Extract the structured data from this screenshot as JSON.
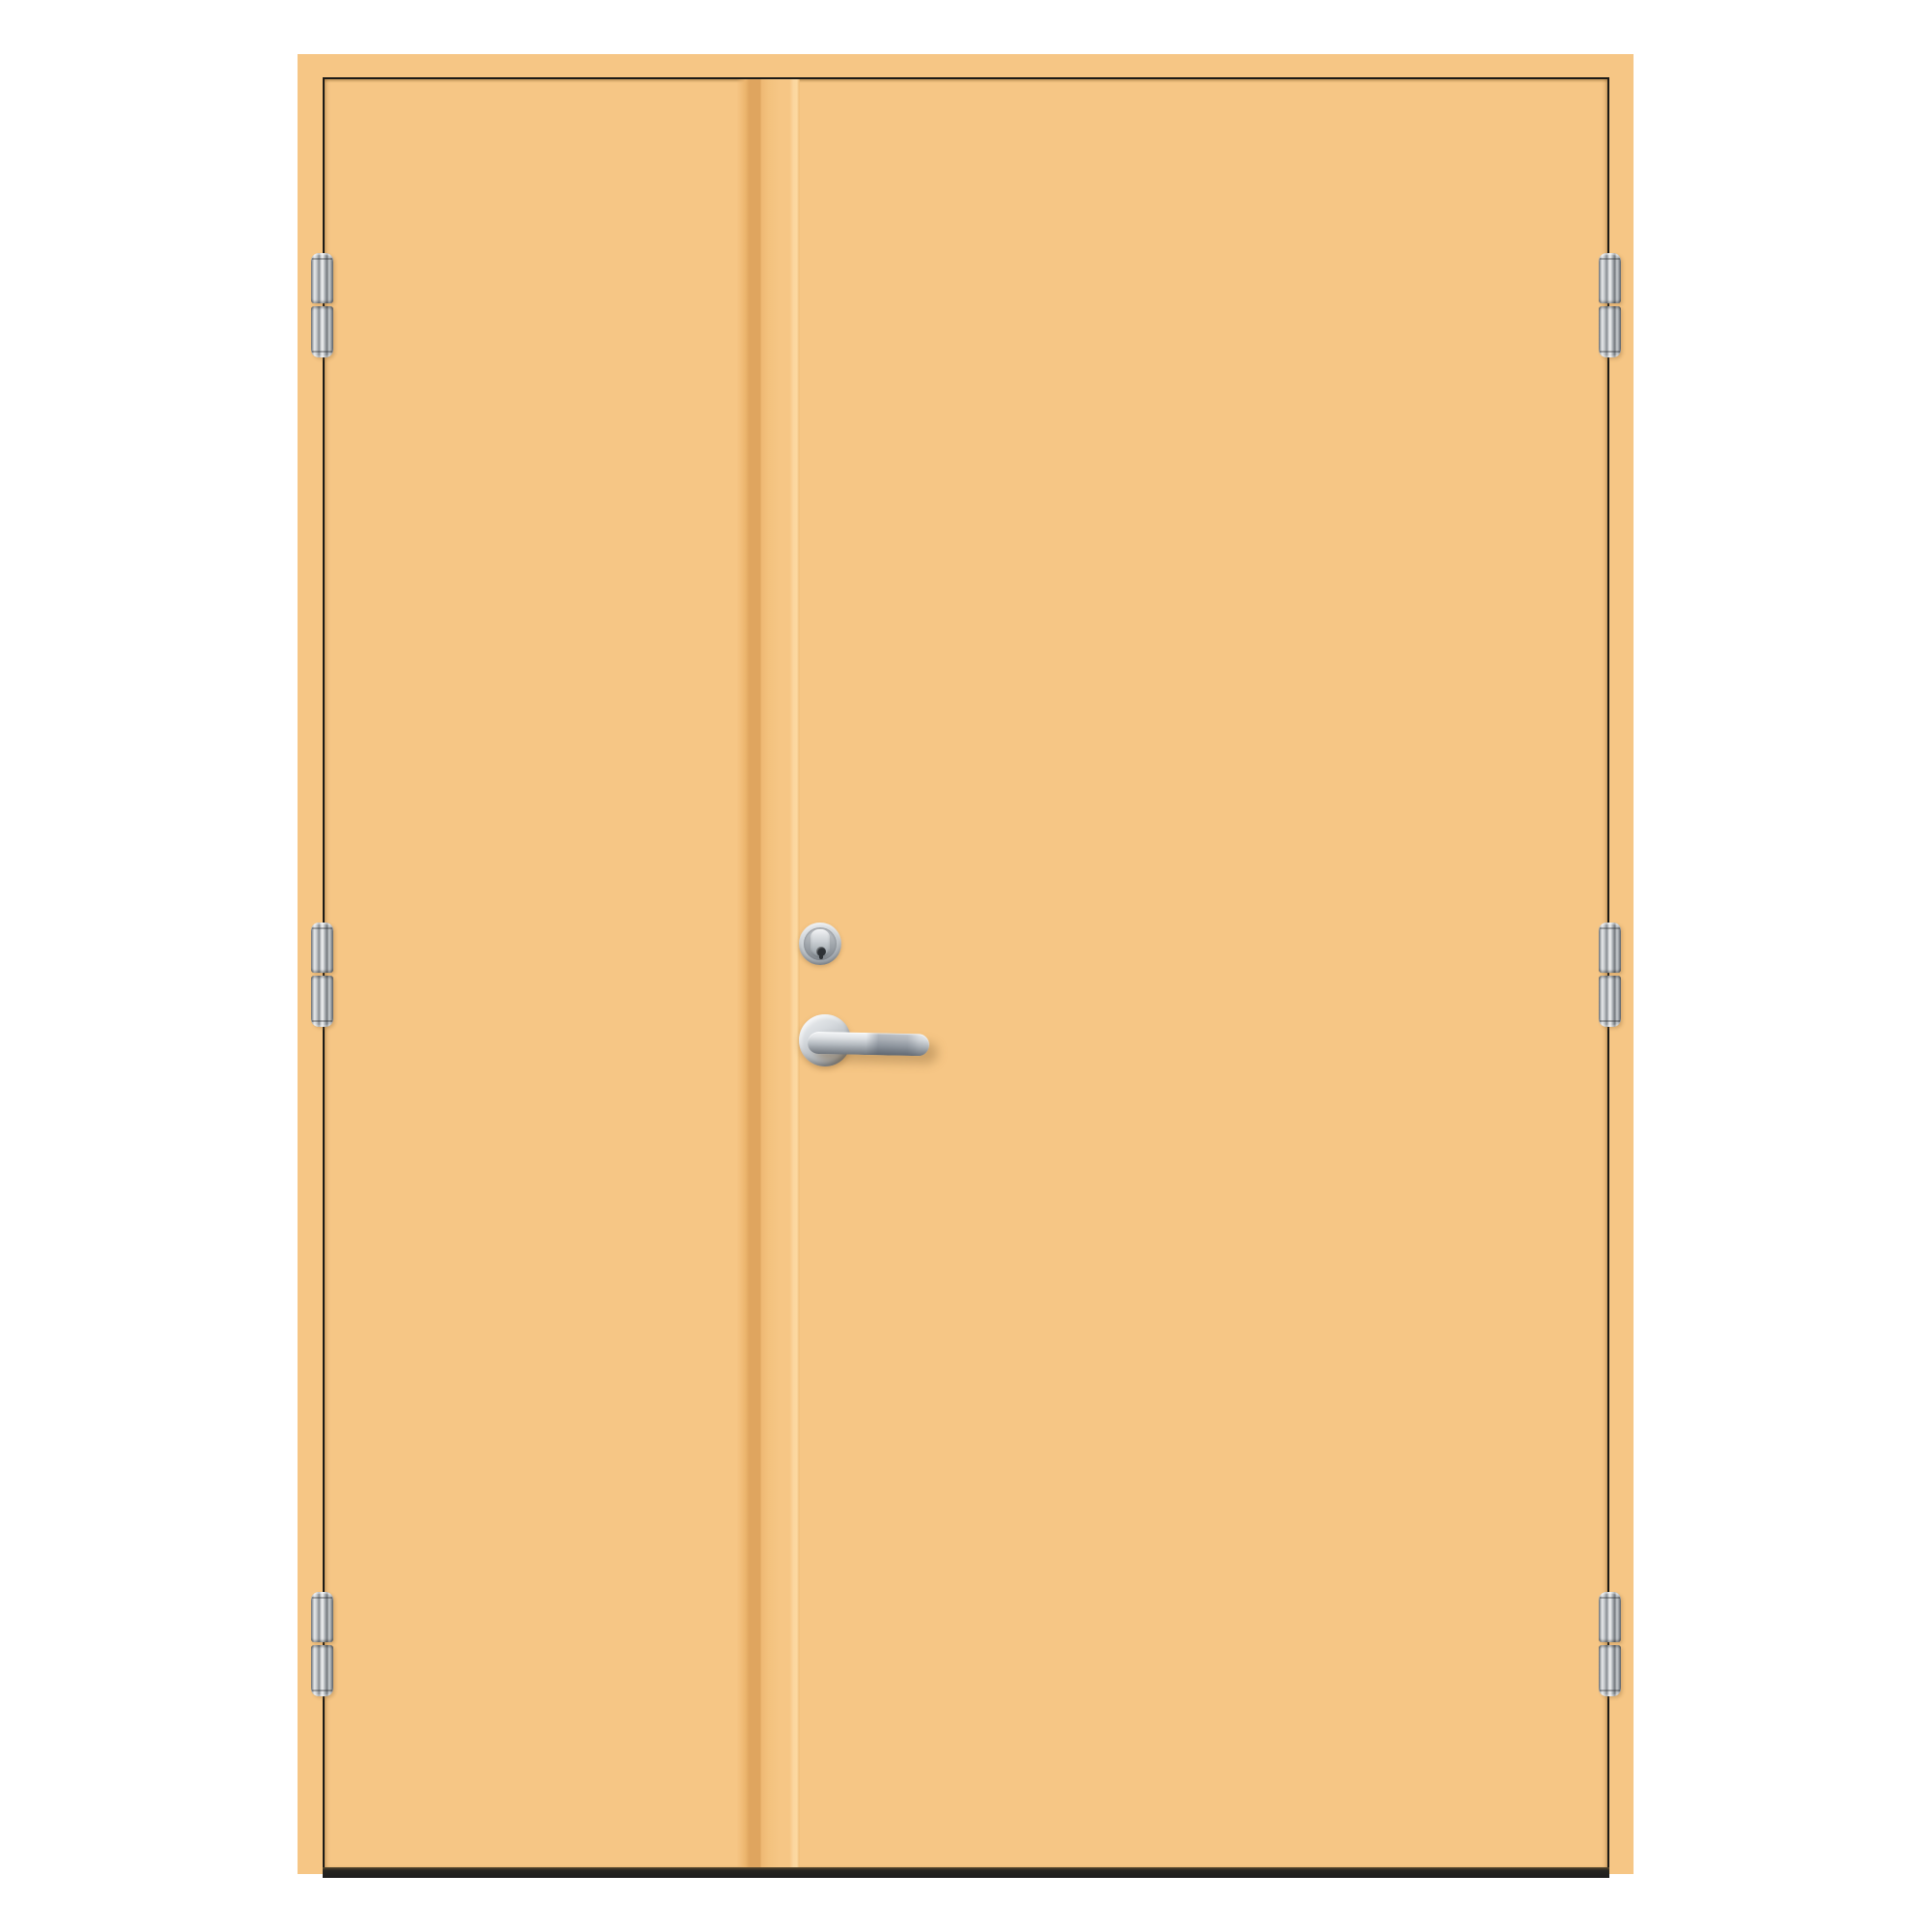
{
  "scene": {
    "description": "Product image of a double exterior door with two unequal plain leaves, painted light orange, on a white background",
    "leaf_count": 2,
    "hinge_count": 6,
    "hinges_per_side": 3,
    "hardware": [
      "barrel-hinges",
      "lock-cylinder",
      "lever-handle"
    ],
    "hardware_finish": "chrome",
    "handle_position": "right leaf, beside meeting stile",
    "visible_text": ""
  },
  "colors": {
    "background": "#ffffff",
    "door_face": "#f6c685",
    "seam_shadow": "#dfa55f",
    "seam_highlight": "#fcd9a2",
    "gap_line": "#1d1b17",
    "threshold_dark": "#1d1d1d",
    "chrome_highlight": "#eef1f3",
    "chrome_mid": "#c0c6cc",
    "chrome_shadow": "#757b82"
  }
}
